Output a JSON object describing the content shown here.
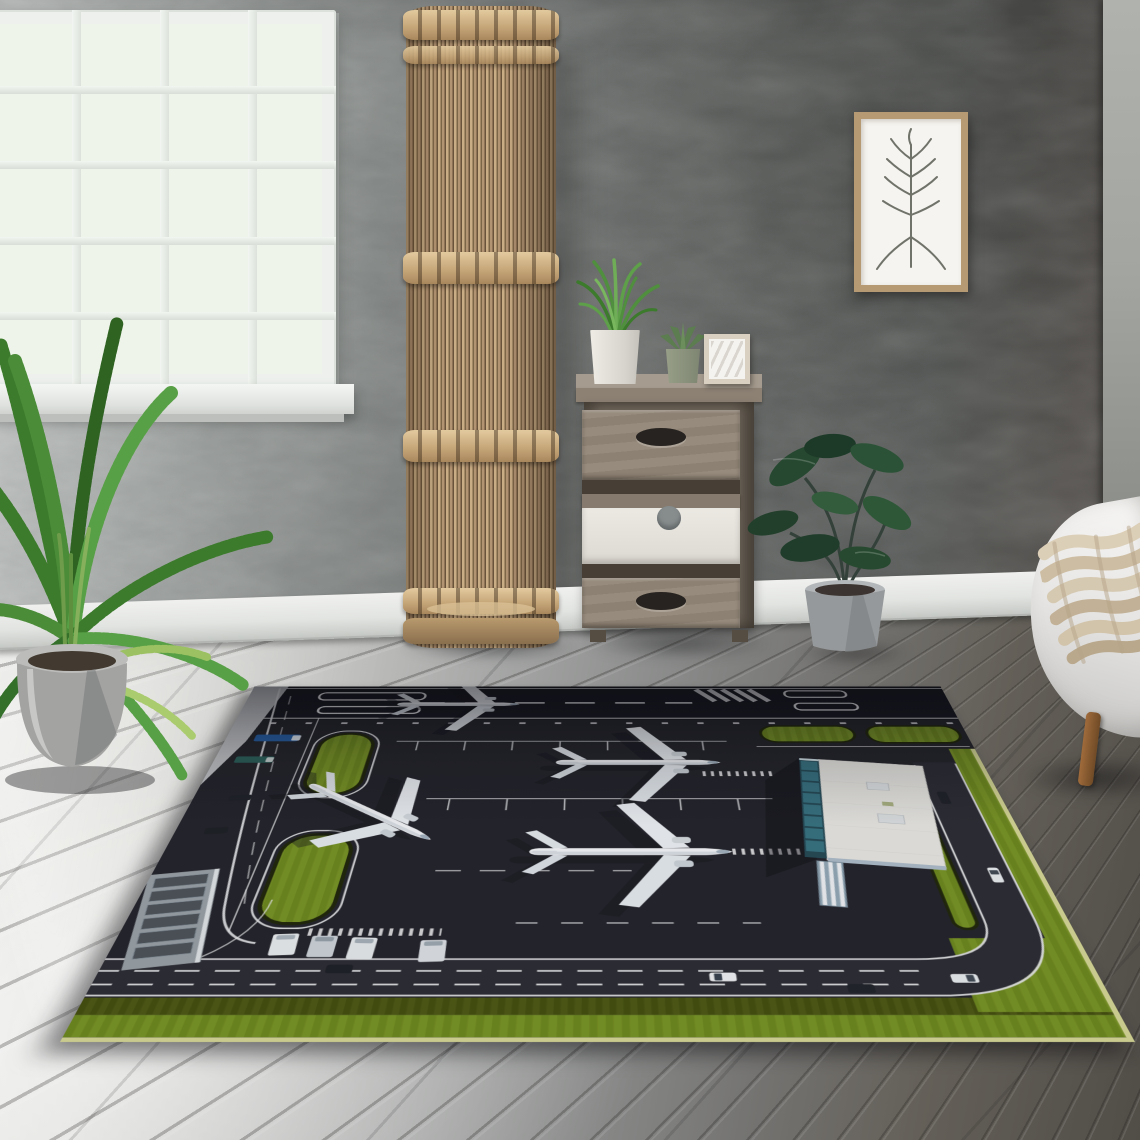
{
  "scene": {
    "type": "interior product photograph",
    "subject": "airport-themed area rug displayed in a living room",
    "lighting": "daylight from a window on the left"
  },
  "room": {
    "wall": {
      "finish": "textured plaster",
      "left_color": "#b5b9b8",
      "right_color": "#565350",
      "corner_strip_color": "#a3a5a1"
    },
    "window": {
      "pane_columns": 4,
      "pane_rows": 5,
      "frame_color": "#edf0ec",
      "view": "bright blurred green garden",
      "sill_color": "#f4f6f3"
    },
    "baseboard": {
      "color": "#eef0ed"
    },
    "floor": {
      "material": "wide wood planks",
      "near_color": "#e9e9e7",
      "far_color": "#514d47"
    },
    "floor_lamp": {
      "style": "tall cylindrical bamboo-slat cage",
      "height_bands": 5,
      "wood_color": "#c2a378"
    },
    "cabinet": {
      "drawers": 3,
      "wood_color": "#8d8174",
      "middle_drawer_front": "#ece9e3",
      "items_on_top": [
        "white pot with grass plant",
        "sage pot with succulent",
        "small blank canvas frame"
      ]
    },
    "wall_art": {
      "frame_color": "#b59a73",
      "subject": "minimal botanical branch sketch",
      "paper_color": "#f6f4f0"
    },
    "plants": [
      {
        "name": "areca palm",
        "pot_color": "#a8a8a6",
        "position": "front left"
      },
      {
        "name": "rubber fig",
        "pot_color": "#9b9ea0",
        "position": "right of cabinet"
      }
    ],
    "sofa": {
      "upholstery_color": "#f0efed",
      "throw": "chunky knit, beige",
      "throw_color": "#d6c9b2",
      "leg_color": "#8a5a33",
      "position": "bottom right edge"
    }
  },
  "rug": {
    "theme": "aerial view of an airport",
    "airplanes": {
      "count": 4,
      "details": [
        {
          "location": "runway, top",
          "heading": "right",
          "size": "medium"
        },
        {
          "location": "apron, center-left",
          "heading": "diagonal lower-right",
          "size": "large"
        },
        {
          "location": "apron, center-right upper",
          "heading": "right",
          "size": "large"
        },
        {
          "location": "apron, center-right lower",
          "heading": "right",
          "size": "large"
        }
      ],
      "body_color": "#f4f6f8"
    },
    "vehicles": {
      "cars": 8,
      "trucks": 2,
      "vans": 4,
      "truck_colors": [
        "#2a62a6",
        "#2f635c"
      ]
    },
    "features": [
      "runway with dashed centerline, threshold boxes and zebra stripes",
      "white apron stand markings and tick rows",
      "two rounded grass taxiway islands",
      "terminal building with white roof, teal glass facade and striped jet bridge",
      "small service building with dark roof panels",
      "perimeter service road with dashed lanes and curved corner",
      "grass borders along bottom and right edges"
    ],
    "colors": {
      "asphalt": "#26262d",
      "runway": "#1b1b22",
      "concrete": "#c6c8ca",
      "markings": "#e8e9ea",
      "grass_bright": "#7a9527",
      "grass_dark": "#4f5a16",
      "grass_fringe": "#d6d896",
      "terminal_roof": "#e8e7e2",
      "terminal_glass": "#3a7482"
    }
  }
}
